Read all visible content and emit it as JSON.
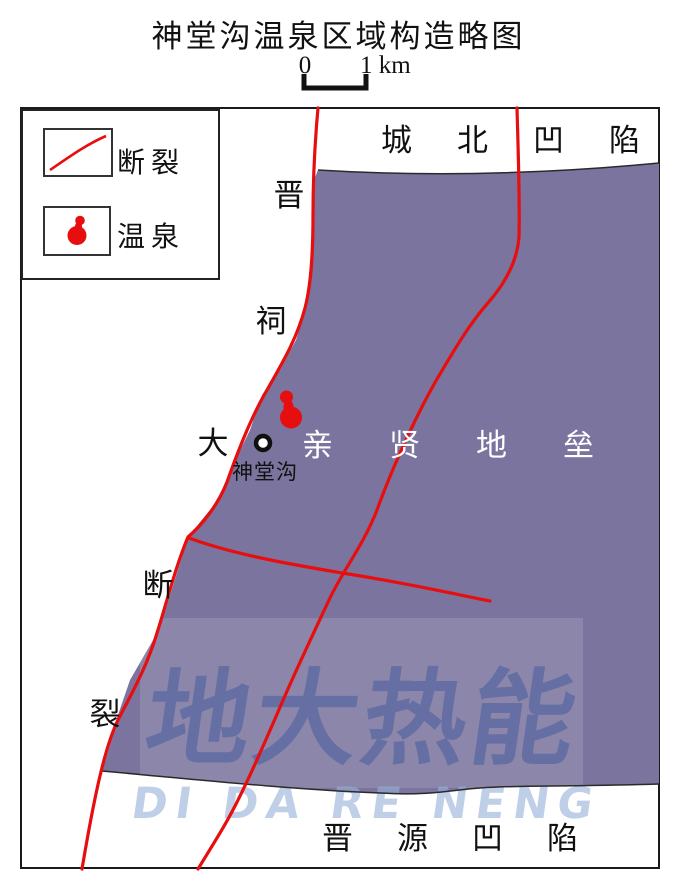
{
  "title": "神堂沟温泉区域构造略图",
  "scale_bar": {
    "zero": "0",
    "one_km": "1 km"
  },
  "legend": {
    "fault_label": "断裂",
    "spring_label": "温泉"
  },
  "map": {
    "region_top": {
      "name": "城北凹陷",
      "chars": [
        "城",
        "北",
        "凹",
        "陷"
      ]
    },
    "region_middle": {
      "name": "亲贤地垒",
      "chars": [
        "亲",
        "贤",
        "地",
        "垒"
      ]
    },
    "region_bottom": {
      "name": "晋源凹陷",
      "chars": [
        "晋",
        "源",
        "凹",
        "陷"
      ]
    },
    "fault_name": {
      "name": "晋祠大断裂",
      "chars": [
        "晋",
        "祠",
        "大",
        "断",
        "裂"
      ]
    },
    "spring_point_label": "神堂沟"
  },
  "watermark": {
    "cn": "地大热能",
    "en": "DI DA RE NENG"
  },
  "colors": {
    "fault_red": "#e60e0e",
    "spring_red": "#e60e0e",
    "horst_purple": "#7b749e",
    "boundary_black": "#2a2a2a",
    "watermark_cn": "rgba(59,86,158,0.48)",
    "watermark_en": "rgba(150,177,217,0.62)"
  }
}
